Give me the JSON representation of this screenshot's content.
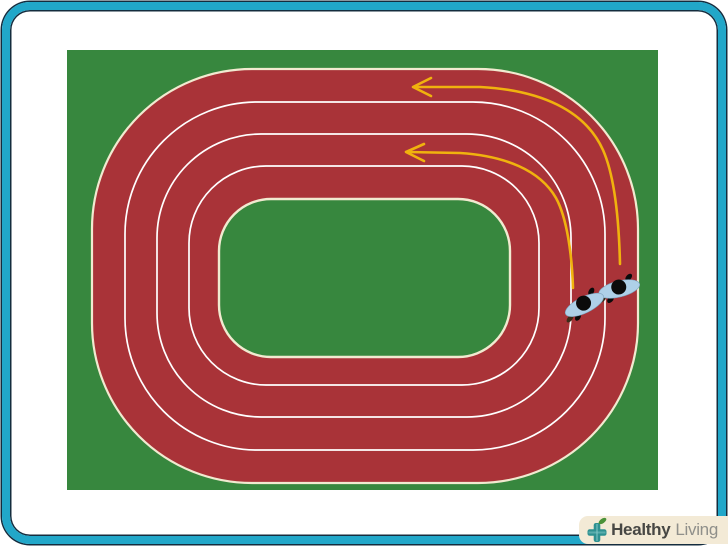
{
  "illustration": {
    "subject": "running track seen from above",
    "lanes": 4,
    "runner_count": 2,
    "arrow_count": 2,
    "running_direction": "counterclockwise"
  },
  "colors": {
    "border_cyan": "#21a7c9",
    "border_dark": "#142c3e",
    "field_green": "#37873e",
    "track_red": "#a93338",
    "track_edge": "#f1ead0",
    "lane_line": "#ffffff",
    "arrow_yellow": "#f0b20e",
    "runner_shirt": "#aed0e8",
    "runner_shirt_edge": "#7fa4bf",
    "runner_dark": "#0b0b0b",
    "runner_shoe": "#3d2b18",
    "logo_bg": "#f3ead6",
    "logo_plus": "#2e9191",
    "logo_plus_highlight": "#7fc4c4",
    "logo_leaf": "#4a9138",
    "logo_text_bold": "#474744",
    "logo_text_light": "#8f8f8a"
  },
  "watermark": {
    "brand_bold": "Healthy",
    "brand_light": "Living"
  }
}
